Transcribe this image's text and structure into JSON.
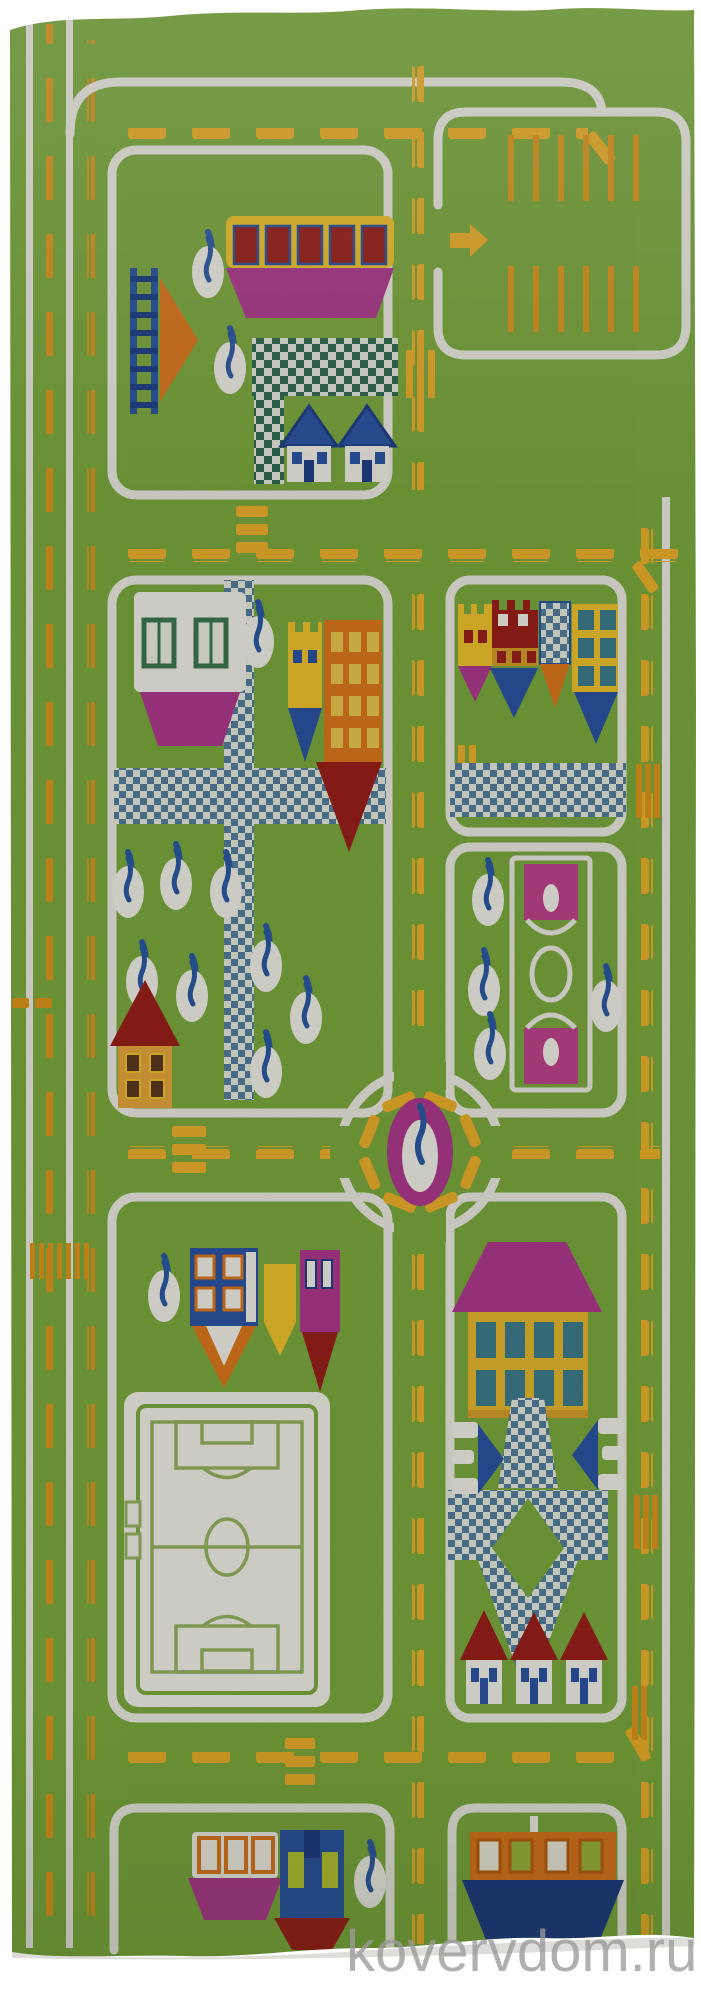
{
  "image": {
    "type": "product-photo",
    "subject": "children-play-rug-city-roads",
    "description": "Green kids' play rug photographed on a white background: white-bordered roads with yellow dashed lane markings, a left multi-lane highway, two parking lots with an arrow, colorful flat buildings and castle towers with pennant-shaped bases, checkered pedestrian paths, white oval trees with blue trunks, a roundabout with a tree in a magenta ring, a basketball court, a soccer field, red-roofed houses, a tram and boats."
  },
  "watermark": {
    "text": "kovervdom.ru",
    "color": "#9a9a9a"
  },
  "palette": {
    "photo_bg": "#ffffff",
    "grass": "#7eac3f",
    "grass_light": "#8db84d",
    "road_white": "#edeee4",
    "dash_yellow": "#f0b22a",
    "dash_orange": "#e0981c",
    "checker_teal": "#2f6b52",
    "checker_blue": "#55809f",
    "checker_white": "#e9ecdf",
    "magenta": "#b13a90",
    "maroon": "#9c211a",
    "orange": "#e0791e",
    "blue": "#2a55a5",
    "blue_dark": "#1e3f86",
    "teal_window": "#3e7d8f",
    "yellow_bld": "#f2c52c",
    "yellow_deep": "#d8a12b",
    "house_wall": "#e9a83c",
    "white_bld": "#f4f3ea",
    "window_dark": "#5b3a20",
    "lime_window": "#b9c732",
    "trunk": "#2d5ba6",
    "field_line": "#97b561",
    "court_pink": "#c2458f",
    "watermark": "#9a9a9a"
  },
  "scene": {
    "elements": [
      "left-highway",
      "top-road",
      "middle-road",
      "roundabout-road",
      "bottom-road",
      "main-vertical-road",
      "right-vertical-road",
      "parking-lots",
      "parking-arrow",
      "bus-building",
      "ladder",
      "orange-signal-tree",
      "checker-paths",
      "blue-roof-houses",
      "white-factory-building",
      "yellow-tower",
      "orange-tower",
      "castle-row",
      "park-trees",
      "red-roof-house",
      "basketball-court",
      "roundabout-tree",
      "soccer-field",
      "pin-houses",
      "magenta-roof-house",
      "diamond-walkway",
      "route-number-signs",
      "small-red-roof-houses",
      "tram",
      "blue-depot",
      "boat"
    ]
  }
}
